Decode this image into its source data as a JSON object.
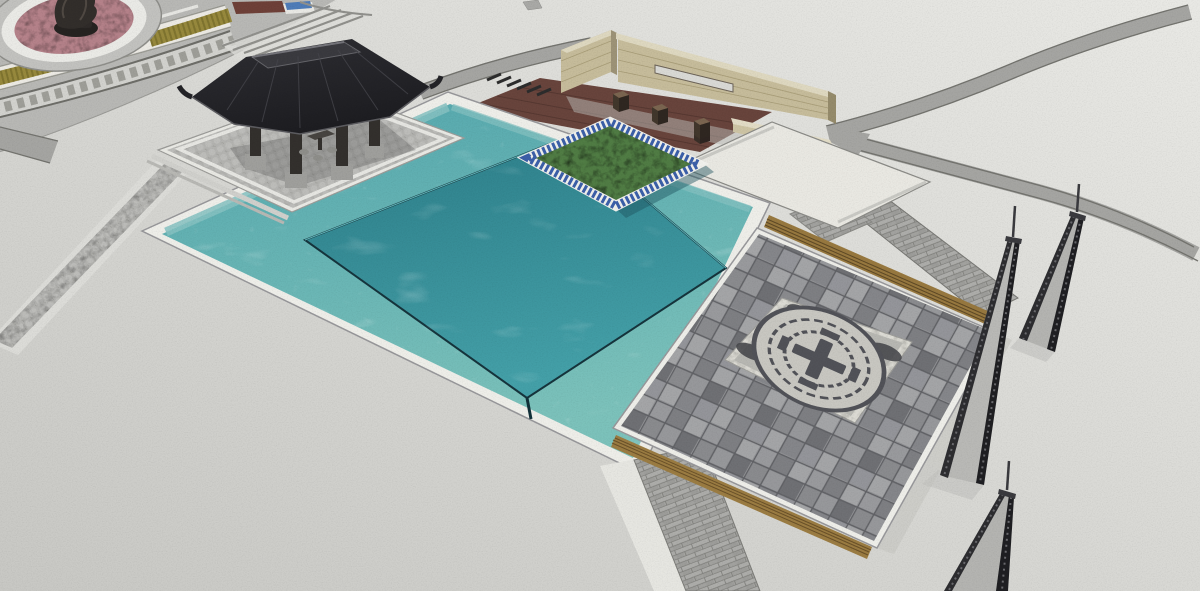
{
  "palette": {
    "ground_top": "#e9e9e5",
    "ground_bottom": "#c8c8c4",
    "road": "#a5a5a2",
    "road_edge": "#73736e",
    "circle_pavement": "#b8b8b5",
    "meander_light": "#d2d2ce",
    "meander_dark": "#6d6d68",
    "planter_olive": "#97893d",
    "planter_dark": "#6f6527",
    "mound_pink": "#b5828a",
    "statue_bronze": "#322e2b",
    "bench_blue": "#4f7cb8",
    "band_brown": "#6e4038",
    "cobble": "#b3b3b0",
    "border_white": "#e9e9e4",
    "coping_white": "#eeeee9",
    "water_top": "#55a8ae",
    "water_bottom": "#7cc2bb",
    "inner_top": "#2c7d88",
    "inner_bottom": "#44a0a8",
    "water_edge": "#16343c",
    "ledge": "#86c2c2",
    "island_green": "#507c44",
    "mosaic_blue": "#3b5fa8",
    "island_white": "#efefe9",
    "deck_wood": "#68443c",
    "deck_line": "#543630",
    "post_dark": "#3a2f26",
    "post_top": "#7a6550",
    "wall_tan": "#c6bc9b",
    "wall_cap": "#ded8c0",
    "wall_side": "#9d9377",
    "concrete": "#e9e8e2",
    "roof_dark": "#232327",
    "roof_ridge": "#3a3a3f",
    "roof_line": "#515157",
    "column_wood": "#33302d",
    "stone_base": "#9f9f9c",
    "plaza_base": "#8f9093",
    "paver_dark": "#6f7074",
    "paver_light": "#a4a5a7",
    "paver_line": "#606165",
    "terrazzo": "#dcdbd4",
    "panel_inner": "#b7b7b2",
    "medallion_face": "#c8c7c1",
    "medallion_dark": "#515258",
    "cloud": "#46474b",
    "bench_wood": "#97783f",
    "bench_slat": "#5f4a26",
    "slab_face": "#b9b9b6",
    "slab_dark": "#26262a",
    "shadow": "#bdbdb9"
  },
  "scene": {
    "type": "aerial-3d-architectural-render",
    "view": "perspective-from-above",
    "elements": [
      {
        "name": "memorial-circle-plaza",
        "features": [
          "bronze-sculpture",
          "pink-paved-mound",
          "annular-flower-planters",
          "greek-key-pattern-ring",
          "curved-amphitheater-steps",
          "brown-seat-band",
          "blue-bench"
        ]
      },
      {
        "name": "chinese-pavilion",
        "features": [
          "black-hip-roof",
          "upturned-eaves",
          "four-timber-columns",
          "stone-column-bases",
          "tea-table-and-stools"
        ]
      },
      {
        "name": "pavilion-terrace",
        "features": [
          "granite-cobble-paving",
          "white-border-band",
          "corner-steps"
        ]
      },
      {
        "name": "reflecting-pool",
        "features": [
          "outer-pool",
          "raised-inner-pool",
          "infinity-edge",
          "white-coping",
          "submerged-ledge"
        ]
      },
      {
        "name": "planted-island",
        "features": [
          "white-rim",
          "blue-mosaic-border",
          "green-groundcover"
        ]
      },
      {
        "name": "timber-boardwalk",
        "features": [
          "red-brown-plank-deck",
          "timber-bollards",
          "drain-grate"
        ]
      },
      {
        "name": "entry-walls",
        "features": [
          "tan-brick-masonry",
          "slot-window",
          "low-seat-wall",
          "end-pier"
        ]
      },
      {
        "name": "coin-plaza",
        "features": [
          "two-tone-paver-grid",
          "terrazzo-center-panel",
          "circular-coin-medallion",
          "corner-cloud-motifs",
          "timber-bench-edges"
        ]
      },
      {
        "name": "inclined-steles",
        "count": 3,
        "features": [
          "light-stone-face",
          "dark-frame-edges",
          "top-pins"
        ]
      },
      {
        "name": "circulation",
        "features": [
          "curved-vehicular-roads",
          "road-loop",
          "cobble-walkway",
          "paver-path"
        ]
      }
    ]
  }
}
